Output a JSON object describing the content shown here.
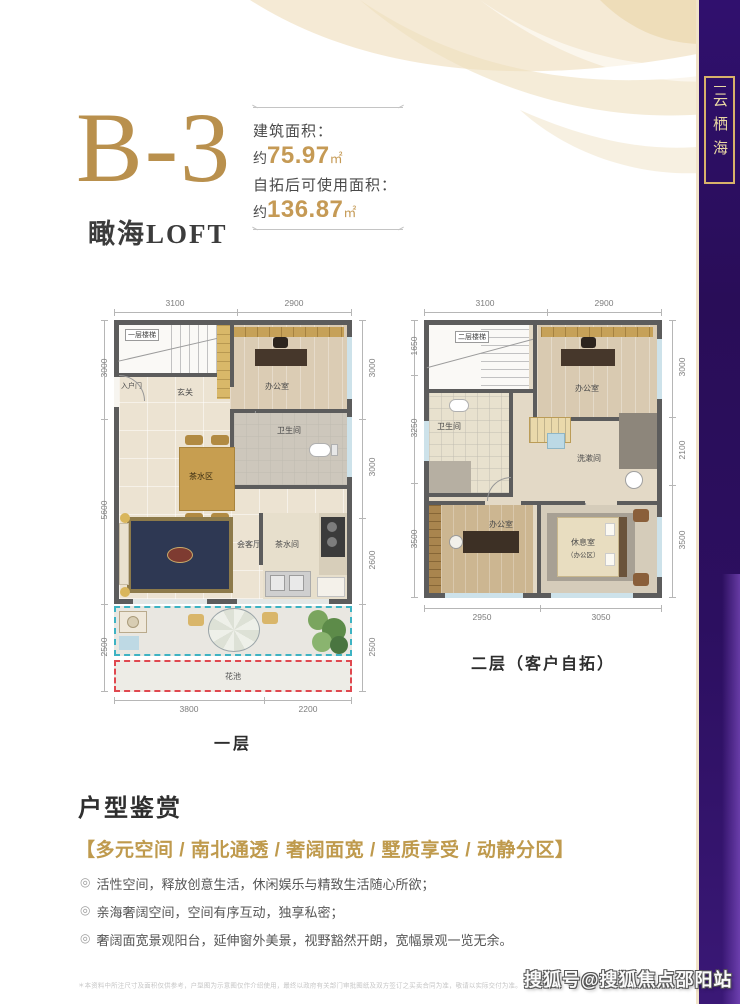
{
  "side_banner": {
    "label": "云栖海"
  },
  "header": {
    "unit_code": "B-3",
    "subtitle": "瞰海LOFT",
    "spec": {
      "line1_label": "建筑面积：",
      "line1_prefix": "约",
      "line1_value": "75.97",
      "line1_unit": "㎡",
      "line2_label": "自拓后可使用面积：",
      "line2_prefix": "约",
      "line2_value": "136.87",
      "line2_unit": "㎡"
    }
  },
  "floor1": {
    "caption": "一层",
    "dims_top": [
      "3100",
      "2900"
    ],
    "dims_left": [
      "3000",
      "5600",
      "2500"
    ],
    "dims_right": [
      "3000",
      "3000",
      "2600",
      "2500"
    ],
    "dims_bottom": [
      "3800",
      "2200"
    ],
    "rooms": {
      "stairs": "一层楼梯",
      "entry": "入户门",
      "foyer": "玄关",
      "office": "办公室",
      "tea_area": "茶水区",
      "bathroom": "卫生间",
      "living": "会客厅",
      "pantry": "茶水间",
      "flower_bed": "花池"
    }
  },
  "floor2": {
    "caption": "二层（客户自拓）",
    "dims_top": [
      "3100",
      "2900"
    ],
    "dims_left": [
      "1650",
      "3250",
      "3500"
    ],
    "dims_right": [
      "3000",
      "2100",
      "3500"
    ],
    "dims_bottom": [
      "2950",
      "3050"
    ],
    "rooms": {
      "stairs": "二层楼梯",
      "office_top": "办公室",
      "bathroom": "卫生间",
      "washroom": "洗漱间",
      "office_bottom": "办公室",
      "lounge": "休息室",
      "lounge_sub": "（办公区）"
    }
  },
  "appreciation": {
    "title": "户型鉴赏",
    "highlight": "【多元空间 / 南北通透 / 奢阔面宽 / 墅质享受 / 动静分区】",
    "bullet_icon": "◎",
    "bullets": [
      "活性空间，释放创意生活，休闲娱乐与精致生活随心所欲；",
      "亲海奢阔空间，空间有序互动，独享私密；",
      "奢阔面宽景观阳台，延伸窗外美景，视野豁然开朗，宽幅景观一览无余。"
    ]
  },
  "footer": {
    "disclaimer": "＊本资料中所注尺寸及面积仅供参考，户型图为示意图仅作介绍使用，最终以政府有关部门审批图纸及双方签订之买卖合同为准，敬请以实际交付为准。",
    "watermark": "搜狐号@搜狐焦点邵阳站"
  },
  "colors": {
    "gold": "#bf9a4d",
    "deep_purple": "#2c0f60",
    "wall": "#5c5c5c",
    "balcony_dash": "#3db3c3",
    "flower_dash": "#e0484f"
  }
}
